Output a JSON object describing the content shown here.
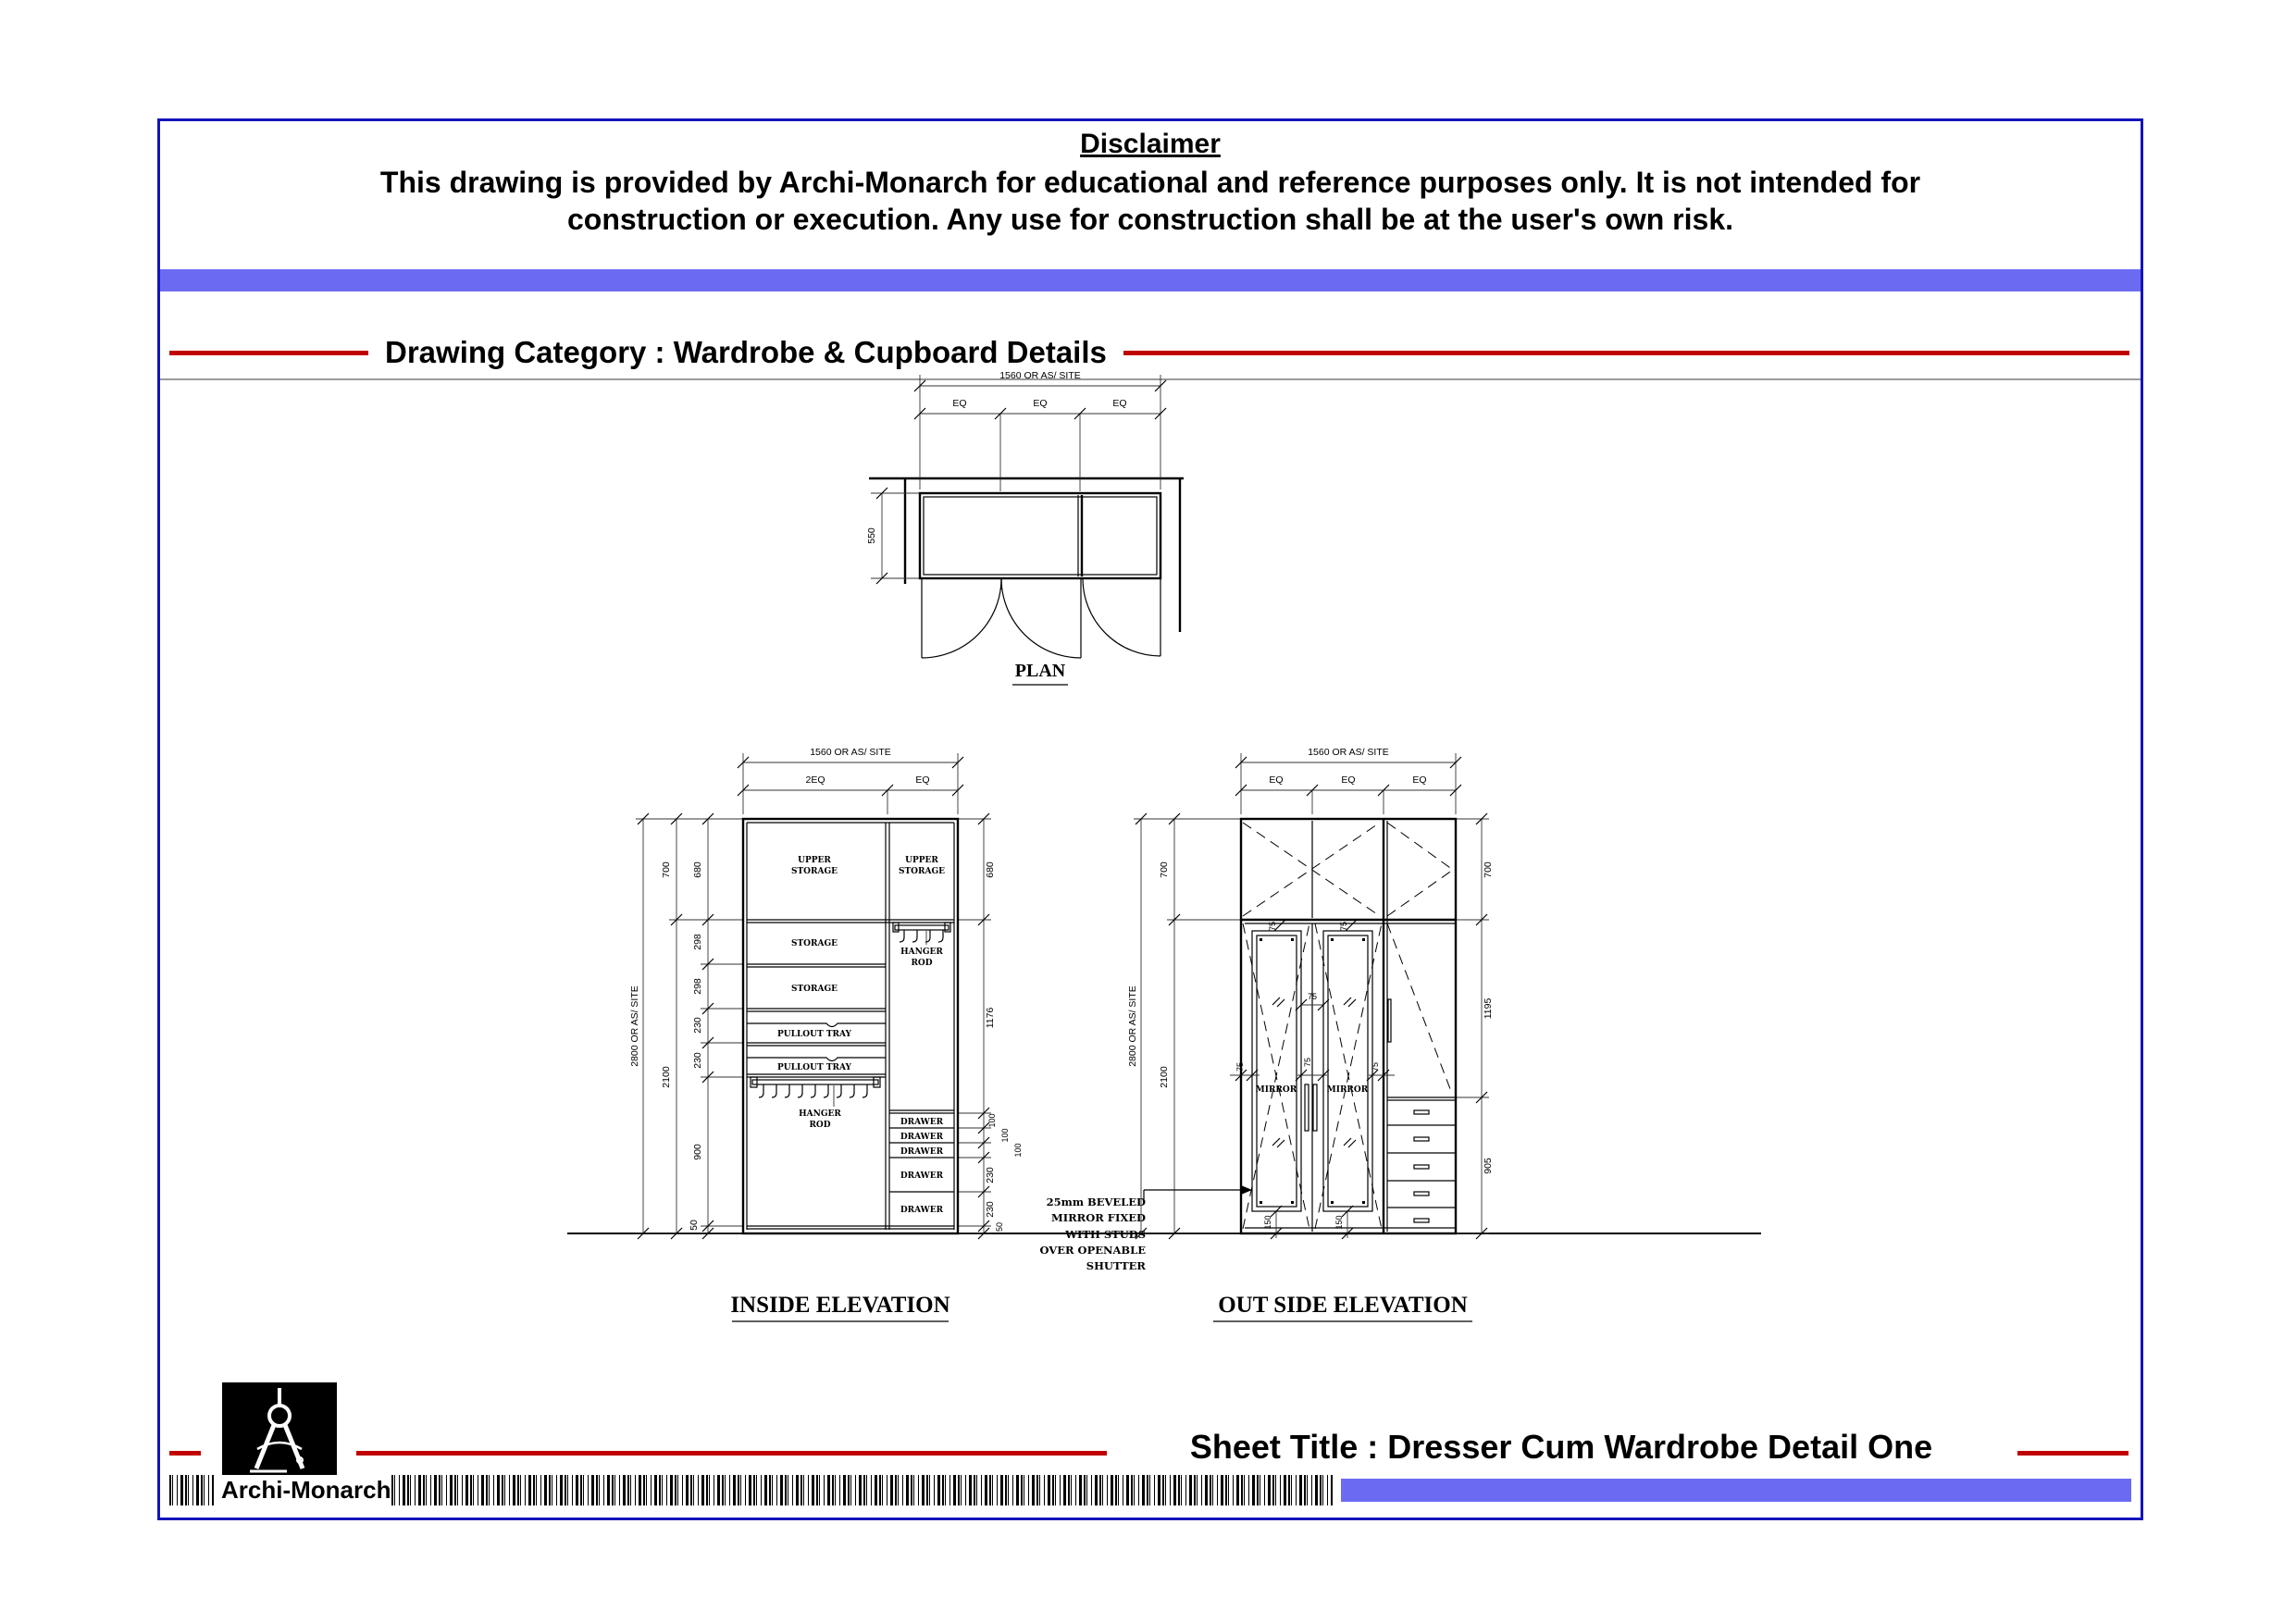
{
  "colors": {
    "sheet_border": "#1414bb",
    "accent_bar": "#6b6bf2",
    "rule_red": "#c00000",
    "divider_gray": "#9a9a9a",
    "logo_background": "#000000"
  },
  "disclaimer": {
    "title": "Disclaimer",
    "line1": "This drawing is provided by Archi-Monarch for educational and reference purposes only. It is not intended for",
    "line2": "construction or execution. Any use for construction shall be at the user's own risk."
  },
  "category": {
    "heading": "Drawing Category : Wardrobe & Cupboard Details"
  },
  "plan": {
    "title": "PLAN",
    "dim_width": "1560 OR AS/ SITE",
    "eq": [
      "EQ",
      "EQ",
      "EQ"
    ],
    "dim_depth": "550"
  },
  "inside_elevation": {
    "title": "INSIDE ELEVATION",
    "dim_width": "1560 OR AS/ SITE",
    "width_segments": [
      "2EQ",
      "EQ"
    ],
    "dim_height": "2800 OR AS/ SITE",
    "left_outer": [
      "700",
      "2100"
    ],
    "left_inner": [
      "680",
      "298",
      "298",
      "230",
      "230",
      "900",
      "50"
    ],
    "right_chain": [
      "680",
      "1176",
      "100",
      "100",
      "100",
      "230",
      "230",
      "50"
    ],
    "upper_storage": [
      "UPPER",
      "STORAGE"
    ],
    "storages": [
      "STORAGE",
      "STORAGE"
    ],
    "trays": [
      "PULLOUT TRAY",
      "PULLOUT TRAY"
    ],
    "hanger": [
      "HANGER",
      "ROD"
    ],
    "drawers": [
      "DRAWER",
      "DRAWER",
      "DRAWER",
      "DRAWER",
      "DRAWER"
    ]
  },
  "outside_elevation": {
    "title": "OUT SIDE ELEVATION",
    "dim_width": "1560 OR AS/ SITE",
    "eq": [
      "EQ",
      "EQ",
      "EQ"
    ],
    "dim_height": "2800 OR AS/ SITE",
    "left_chain": [
      "700",
      "2100"
    ],
    "right_chain": [
      "700",
      "1195",
      "905"
    ],
    "mirror_margins": [
      "75",
      "75",
      "75",
      "75",
      "75",
      "75"
    ],
    "mirror_bottom": [
      "150",
      "150"
    ],
    "mirrors": [
      "MIRROR",
      "MIRROR"
    ],
    "note": [
      "25mm BEVELED",
      "MIRROR FIXED",
      "WITH STUDS",
      "OVER OPENABLE",
      "SHUTTER"
    ]
  },
  "footer": {
    "brand": "Archi-Monarch",
    "sheet_title": "Sheet Title : Dresser Cum Wardrobe Detail One"
  }
}
